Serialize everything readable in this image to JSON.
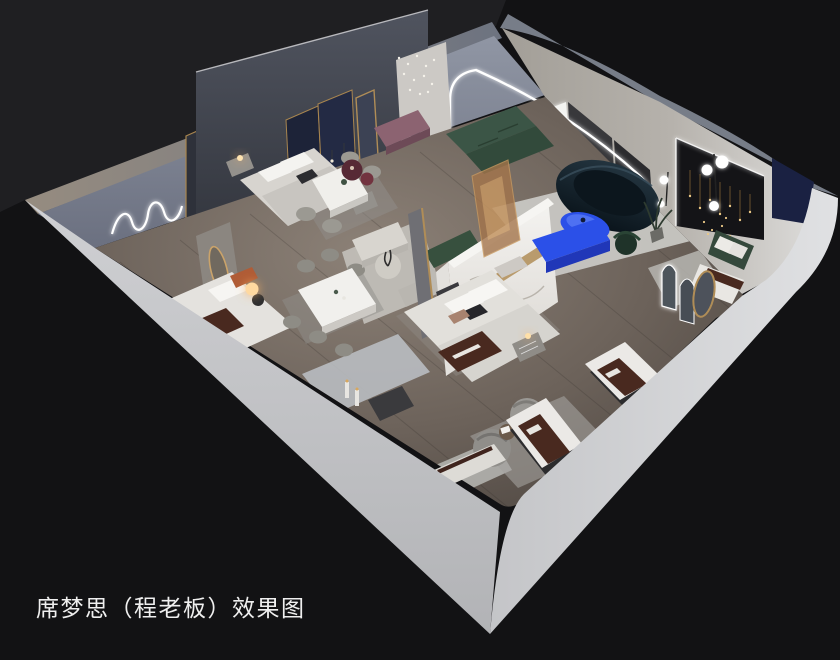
{
  "caption": {
    "text": "席梦思（程老板）效果图"
  },
  "palette": {
    "bg": "#121214",
    "backdrop": "#1f1f22",
    "wall-light": "#c7c8cb",
    "wall-bright": "#d8d9db",
    "wall-top": "#8a8177",
    "wall-inner": "#7d8494",
    "floor": "#6e645c",
    "rug": "#c2c1bd",
    "accent-blue": "#2b50e8",
    "sofa-navy": "#0f1d26",
    "sofa-green": "#37503e",
    "runner-maroon": "#49291f",
    "gold": "#b08d57",
    "mauve": "#8c6371",
    "marble": "#f2f1ee",
    "led": "#ffffff",
    "caption": "#efefef"
  },
  "scene": {
    "type": "isometric-cutaway-interior-rendering",
    "areas": [
      "back-bedroom-left",
      "front-bedroom-left",
      "dining-area-back",
      "dining-area-front",
      "lounge-nook",
      "center-bedroom",
      "living-lounge",
      "gallery-room-right",
      "mattress-display-zone"
    ]
  }
}
